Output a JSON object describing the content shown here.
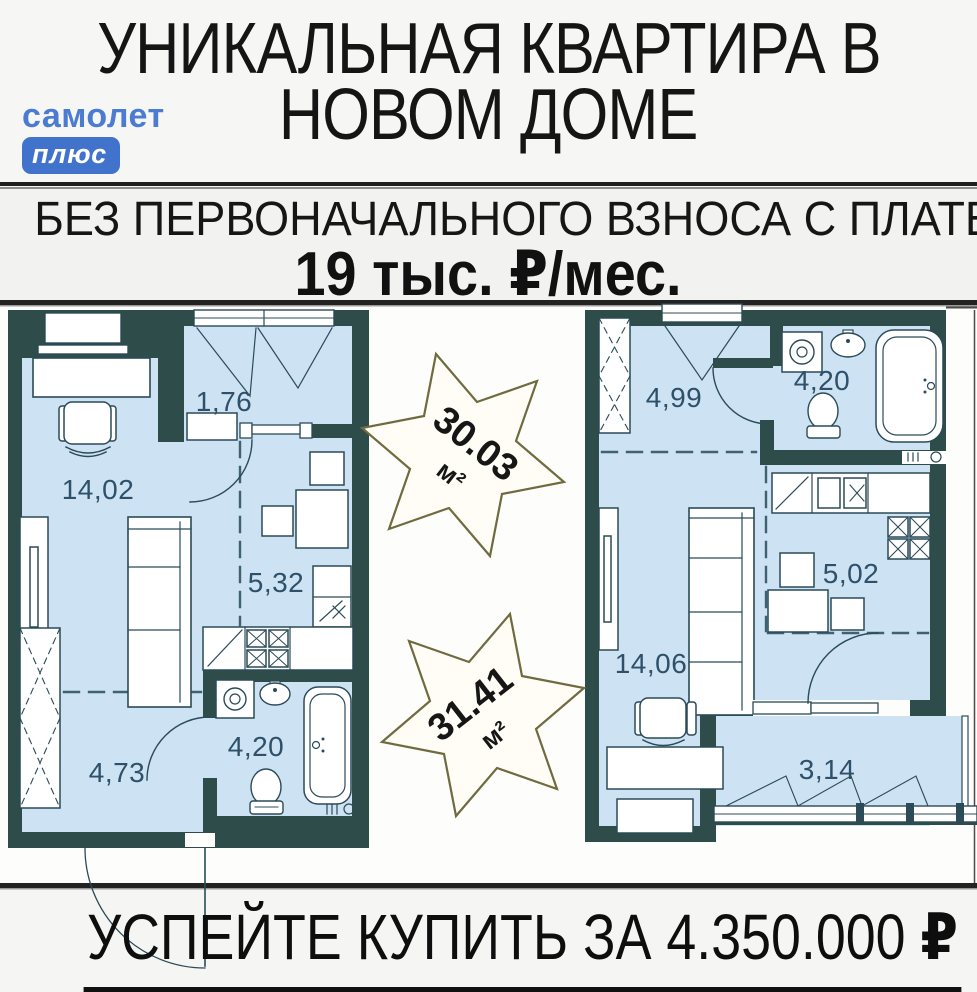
{
  "brand": {
    "name": "самолет",
    "badge": "плюс"
  },
  "title": {
    "line1": "УНИКАЛЬНАЯ КВАРТИРА В",
    "line2": "НОВОМ ДОМЕ"
  },
  "offer": {
    "headline": "БЕЗ ПЕРВОНАЧАЛЬНОГО ВЗНОСА С ПЛАТЕЖОМ",
    "payment": "19 тыс. ₽/мес."
  },
  "cta": {
    "text": "УСПЕЙТЕ КУПИТЬ ЗА 4.350.000 ",
    "currency": "₽"
  },
  "plans": {
    "left": {
      "total_area": "30.03",
      "unit": "м²",
      "rooms": {
        "hall": "1,76",
        "living": "14,02",
        "kitchen": "5,32",
        "corridor": "4,73",
        "bathroom": "4,20"
      }
    },
    "right": {
      "total_area": "31.41",
      "unit": "м²",
      "rooms": {
        "hall": "4,99",
        "bathroom": "4,20",
        "kitchen": "5,02",
        "living": "14,06",
        "balcony": "3,14"
      }
    }
  },
  "colors": {
    "accent_blue": "#4b7cd1",
    "badge_blue": "#4273cc",
    "wall": "#2e4c4a",
    "floor": "#cde2f3",
    "star_outline": "#6f6b3f",
    "room_label": "#2e5068"
  }
}
